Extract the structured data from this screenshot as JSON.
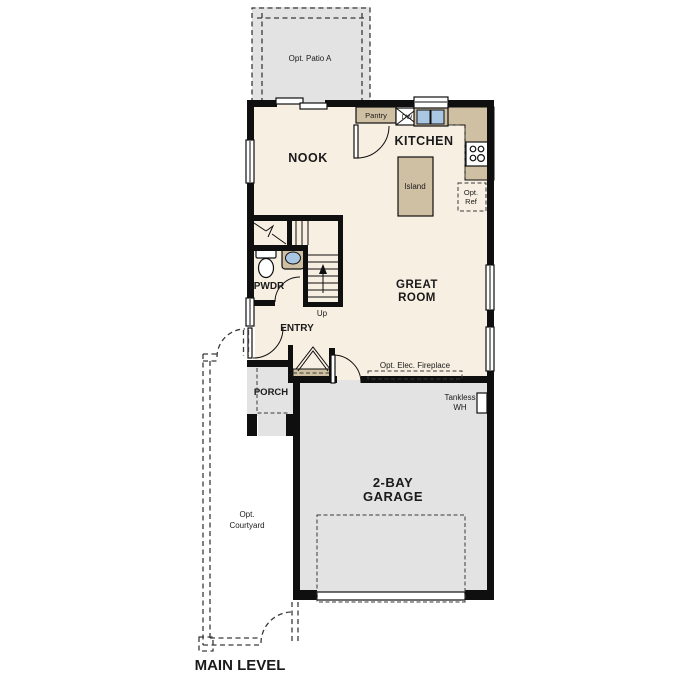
{
  "labels": {
    "patio": "Opt. Patio A",
    "nook": "NOOK",
    "kitchen": "KITCHEN",
    "pantry": "Pantry",
    "dw": "DW",
    "island": "Island",
    "opt_ref_1": "Opt.",
    "opt_ref_2": "Ref",
    "great_1": "GREAT",
    "great_2": "ROOM",
    "pwdr": "PWDR",
    "up": "Up",
    "entry": "ENTRY",
    "porch": "PORCH",
    "fireplace": "Opt. Elec. Fireplace",
    "tankless_1": "Tankless",
    "tankless_2": "WH",
    "garage_1": "2-BAY",
    "garage_2": "GARAGE",
    "courtyard_1": "Opt.",
    "courtyard_2": "Courtyard",
    "level": "MAIN LEVEL"
  },
  "colors": {
    "wall": "#0f0f0f",
    "floor": "#f7efe2",
    "counter": "#cfc0a3",
    "surface_gray": "#e3e3e3",
    "fixture_blue": "#a9c7e3",
    "text": "#1a1a1a"
  }
}
